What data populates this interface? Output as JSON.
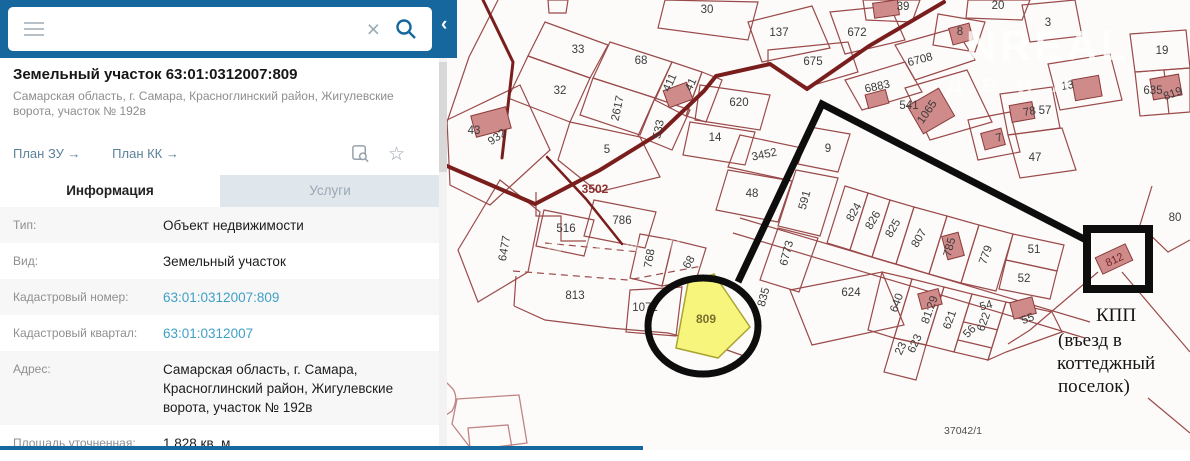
{
  "sidebar": {
    "search": {
      "value": "",
      "placeholder": ""
    },
    "title": "Земельный участок 63:01:0312007:809",
    "subtitle": "Самарская область, г. Самара, Красноглинский район, Жигулевские ворота, участок № 192в",
    "links": {
      "plan_zu": "План ЗУ →",
      "plan_kk": "План КК →"
    },
    "tabs": {
      "info": "Информация",
      "services": "Услуги"
    },
    "rows": [
      {
        "label": "Тип:",
        "value": "Объект недвижимости"
      },
      {
        "label": "Вид:",
        "value": "Земельный участок"
      },
      {
        "label": "Кадастровый номер:",
        "value": "63:01:0312007:809"
      },
      {
        "label": "Кадастровый квартал:",
        "value": "63:01:0312007"
      },
      {
        "label": "Адрес:",
        "value": "Самарская область, г. Самара, Красноглинский район, Жигулевские ворота, участок № 192в"
      },
      {
        "label": "Площадь уточненная:",
        "value": "1 828 кв. м"
      }
    ]
  },
  "map": {
    "colors": {
      "parcel": "#9a4a4a",
      "road": "#7a1d1d",
      "building_fill": "#cf8a8a",
      "building_stroke": "#8b3a3a",
      "highlight_fill": "#f8f57d",
      "highlight_stroke": "#aaa432",
      "annotation": "#0d0d0d",
      "label": "#3b3b3b",
      "accent": "#15679e"
    },
    "highlight": {
      "number": "809",
      "d": "M688,283 L714,274 L750,327 L718,358 L676,348 Z"
    },
    "parcels": [
      "M447,120 L520,85 L550,150 L490,205 L450,185 Z",
      "M545,22 L608,45 L590,78 L528,56 Z",
      "M528,56 L590,78 L570,122 L508,98 Z",
      "M610,42 L672,62 L655,98 L593,78 Z",
      "M593,78 L655,98 L640,135 L580,115 Z",
      "M655,98 L690,110 L672,150 L638,136 Z",
      "M570,122 L640,137 L660,177 L598,192 L558,160 Z",
      "M672,62 L702,72 L686,116 L655,100 Z",
      "M702,72 L722,80 L706,122 L686,116 Z",
      "M665,0 L758,2 L748,40 L658,28 Z",
      "M748,22 L812,6 L830,48 L762,62 Z",
      "M830,12 L890,6 L905,40 L845,54 Z",
      "M768,50 L848,42 L858,72 L807,87 L768,64 Z",
      "M863,0 L920,0 L912,22 L866,20 Z",
      "M895,45 L955,28 L975,60 L915,80 Z",
      "M845,80 L905,62 L922,92 L862,110 Z",
      "M905,88 L967,70 L992,122 L930,140 Z",
      "M968,0 L1030,0 L1022,20 L966,18 Z",
      "M938,14 L985,22 L975,52 L933,45 Z",
      "M1022,5 L1075,0 L1082,36 L1030,42 Z",
      "M1048,64 L1110,54 L1122,100 L1060,110 Z",
      "M1000,94 L1052,87 L1060,128 L1008,135 Z",
      "M968,120 L1010,112 L1020,152 L978,160 Z",
      "M1008,135 L1062,128 L1076,170 L1020,178 Z",
      "M1130,34 L1186,30 L1190,68 L1135,72 Z",
      "M1135,72 L1190,68 L1190,112 L1140,116 Z",
      "M1164,70 L1169,114",
      "M700,85 L770,95 L760,130 L695,120 Z",
      "M690,122 L755,132 L745,165 L683,155 Z",
      "M740,135 L802,148 L788,180 L728,167 Z",
      "M810,127 L850,134 L838,172 L798,164 Z",
      "M728,170 L792,181 L778,222 L716,210 Z",
      "M796,170 L838,178 L820,236 L778,226 Z",
      "M778,228 L818,238 L799,292 L760,280 Z",
      "M640,234 L673,240 L662,286 L630,278 Z",
      "M673,240 L706,248 L696,280 L662,286 Z",
      "M594,200 L656,212 L645,248 L584,236 Z",
      "M544,210 L594,220 L584,256 L536,246 Z",
      "M500,180 L540,212 L528,272 L478,302 L458,250 Z",
      "M536,192 L536,216 L561,216 L561,241 L586,241",
      "M516,276 L514,306",
      "M514,306 L545,320 L610,328 L668,333 L710,344 L744,356",
      "M630,290 L682,287 L676,336 L626,332 Z",
      "M740,218 L1090,322",
      "M733,233 L1085,338",
      "M845,186 L868,193 L850,250 L827,243 Z",
      "M868,193 L890,200 L872,257 L850,250 Z",
      "M890,200 L914,207 L896,264 L872,257 Z",
      "M914,207 L947,216 L929,274 L896,264 Z",
      "M947,216 L979,225 L961,283 L929,274 Z",
      "M979,225 L1013,234 L996,291 L961,283 Z",
      "M1013,234 L1064,245 L1057,271 L1006,260 Z",
      "M1006,260 L1057,271 L1050,299 L999,289 Z",
      "M790,290 L882,272 L904,325 L812,345 Z",
      "M882,272 L912,279 L894,338 L868,330 Z",
      "M912,279 L944,287 L926,345 L894,338 Z",
      "M944,287 L972,294 L954,352 L926,345 Z",
      "M894,338 L926,345 L916,380 L884,372 Z",
      "M972,294 L1006,302 L988,360 L954,352 Z",
      "M964,322 L998,330",
      "M958,340 L992,348",
      "M1006,302 L1052,312 L1062,332 L1006,352 L988,360 Z",
      "M1148,398 L1190,433",
      "M1098,272 L1030,330 L1008,344",
      "M1122,272 L1190,352",
      "M1152,186 L1140,225 L1168,252 L1190,240",
      "M548,0 L568,0 L566,13 L549,13 Z",
      "M498,0 L469,57 L447,122 L441,188"
    ],
    "dashes": [
      "M513,271 L628,280 L702,266",
      "M545,243 L640,252"
    ],
    "light": [
      "M440,376 L453,389 Q459,399 452,411 L440,419",
      "M457,399 L519,395 L527,443 L472,450 L452,424 Z",
      "M470,448 L468,428 L508,425 L512,448"
    ],
    "roads": [
      [
        "M483,0 L513,62 L502,158",
        3
      ],
      [
        "M440,163 L535,204 L600,170 L660,133 L704,91 L716,76 L770,64 L807,89 L869,46 L944,2",
        4
      ],
      [
        "M547,157 L586,199 L622,244",
        2.5
      ]
    ],
    "buildings": [
      [
        491,
        122,
        36,
        22,
        -15
      ],
      [
        678,
        95,
        25,
        18,
        -20
      ],
      [
        886,
        9,
        25,
        15,
        -8
      ],
      [
        877,
        99,
        21,
        14,
        -15
      ],
      [
        931,
        111,
        36,
        32,
        -30
      ],
      [
        961,
        34,
        21,
        17,
        -15
      ],
      [
        1087,
        88,
        27,
        21,
        -10
      ],
      [
        1022,
        112,
        23,
        17,
        -10
      ],
      [
        993,
        139,
        21,
        17,
        -15
      ],
      [
        1166,
        87,
        29,
        21,
        -10
      ],
      [
        953,
        246,
        17,
        24,
        -15
      ],
      [
        930,
        299,
        21,
        16,
        -15
      ],
      [
        1023,
        308,
        23,
        17,
        -15
      ],
      [
        1114,
        259,
        33,
        18,
        -25
      ]
    ],
    "labels": [
      [
        "43",
        474,
        134,
        0
      ],
      [
        "932",
        499,
        140,
        -35
      ],
      [
        "33",
        578,
        53,
        0
      ],
      [
        "32",
        560,
        94,
        0
      ],
      [
        "68",
        641,
        64,
        0
      ],
      [
        "2617",
        621,
        109,
        -78
      ],
      [
        "533",
        662,
        130,
        -78
      ],
      [
        "411",
        673,
        84,
        -65
      ],
      [
        "41",
        694,
        86,
        -65
      ],
      [
        "5",
        607,
        153,
        0
      ],
      [
        "30",
        707,
        13,
        0
      ],
      [
        "137",
        779,
        36,
        0
      ],
      [
        "672",
        857,
        36,
        0
      ],
      [
        "675",
        813,
        65,
        0
      ],
      [
        "39",
        903,
        10,
        0
      ],
      [
        "6708",
        921,
        63,
        -15
      ],
      [
        "6883",
        878,
        90,
        -12
      ],
      [
        "541",
        909,
        109,
        0
      ],
      [
        "1065",
        930,
        114,
        -55
      ],
      [
        "8",
        960,
        35,
        0
      ],
      [
        "20",
        998,
        9,
        0
      ],
      [
        "3",
        1048,
        26,
        0
      ],
      [
        "13",
        1068,
        89,
        -10
      ],
      [
        "78",
        1030,
        115,
        -10
      ],
      [
        "57",
        1045,
        114,
        0
      ],
      [
        "7",
        1000,
        141,
        -15
      ],
      [
        "47",
        1035,
        161,
        0
      ],
      [
        "19",
        1162,
        54,
        0
      ],
      [
        "635",
        1153,
        94,
        0
      ],
      [
        "819",
        1174,
        97,
        -20
      ],
      [
        "80",
        1175,
        221,
        0
      ],
      [
        "620",
        739,
        106,
        0
      ],
      [
        "14",
        715,
        141,
        0
      ],
      [
        "3452",
        765,
        158,
        -12
      ],
      [
        "9",
        828,
        152,
        0
      ],
      [
        "48",
        752,
        197,
        0
      ],
      [
        "591",
        808,
        201,
        -75
      ],
      [
        "6773",
        790,
        254,
        -75
      ],
      [
        "768",
        653,
        259,
        -80
      ],
      [
        "68",
        692,
        264,
        -60
      ],
      [
        "786",
        622,
        224,
        0
      ],
      [
        "516",
        566,
        232,
        0
      ],
      [
        "3502",
        595,
        193,
        0,
        12,
        "#8d2f2f",
        1
      ],
      [
        "6477",
        508,
        249,
        -80
      ],
      [
        "813",
        575,
        299,
        0
      ],
      [
        "1071",
        645,
        311,
        0
      ],
      [
        "809",
        706,
        323,
        0,
        12,
        "#77702d",
        1
      ],
      [
        "835",
        767,
        298,
        -75
      ],
      [
        "824",
        857,
        214,
        -60
      ],
      [
        "826",
        876,
        222,
        -60
      ],
      [
        "825",
        896,
        230,
        -60
      ],
      [
        "807",
        922,
        240,
        -60
      ],
      [
        "785",
        953,
        248,
        -75
      ],
      [
        "779",
        989,
        256,
        -70
      ],
      [
        "51",
        1034,
        253,
        0
      ],
      [
        "52",
        1024,
        282,
        0
      ],
      [
        "624",
        851,
        296,
        0
      ],
      [
        "640",
        900,
        304,
        -70
      ],
      [
        "81:29",
        933,
        311,
        -70
      ],
      [
        "621",
        953,
        321,
        -70
      ],
      [
        "23",
        904,
        350,
        -65
      ],
      [
        "623",
        918,
        345,
        -65
      ],
      [
        "54",
        987,
        309,
        -15
      ],
      [
        "622",
        987,
        323,
        -70
      ],
      [
        "56",
        972,
        334,
        -45
      ],
      [
        "55",
        1029,
        322,
        -20
      ],
      [
        "812",
        1116,
        263,
        -25,
        11,
        "#7c2525"
      ],
      [
        "37042/1",
        963,
        434,
        0,
        10.5,
        "#4f4f4f"
      ]
    ],
    "watermark": [
      [
        "NREAL",
        966,
        60,
        42,
        0.8,
        4
      ],
      [
        "д в и ж",
        946,
        92,
        26,
        0.6,
        6
      ],
      [
        "д в и ж",
        545,
        252,
        26,
        0.32,
        8
      ]
    ],
    "ann": {
      "circle": [
        703,
        326,
        55,
        48
      ],
      "route": "738,282 822,104 1086,240",
      "box": [
        1087,
        229,
        62,
        60
      ],
      "kpp": [
        [
          "КПП",
          1096,
          321
        ],
        [
          "(въезд в",
          1058,
          346
        ],
        [
          "коттеджный",
          1057,
          369
        ],
        [
          "поселок)",
          1058,
          392
        ]
      ]
    }
  }
}
